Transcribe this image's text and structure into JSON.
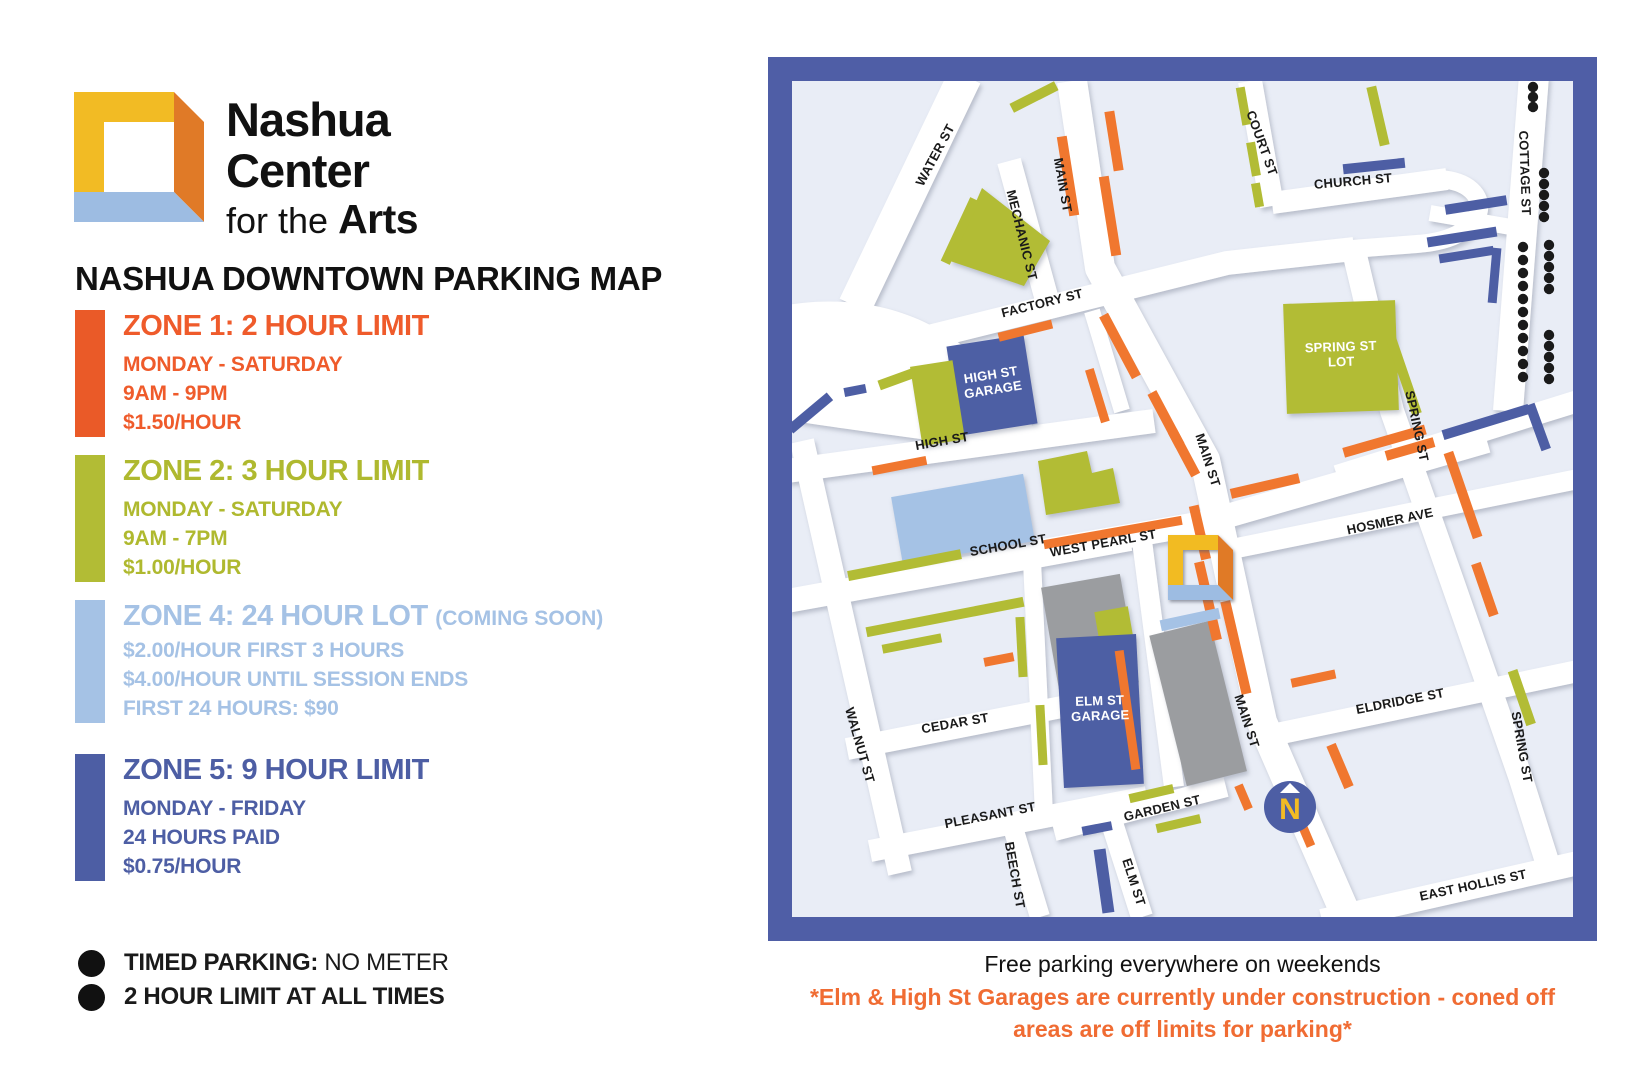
{
  "brand": {
    "name_line1": "Nashua",
    "name_line2": "Center",
    "name_line3_prefix": "for the ",
    "name_line3_bold": "Arts"
  },
  "page_title": "NASHUA DOWNTOWN PARKING MAP",
  "legend": {
    "zones": [
      {
        "name": "ZONE 1:",
        "limit": " 2 HOUR LIMIT",
        "color": "#EF5B2B",
        "details": [
          "MONDAY - SATURDAY",
          "9AM - 9PM",
          "$1.50/HOUR"
        ]
      },
      {
        "name": "ZONE 2:",
        "limit": " 3 HOUR LIMIT",
        "color": "#B2BC35",
        "details": [
          "MONDAY - SATURDAY",
          "9AM - 7PM",
          "$1.00/HOUR"
        ]
      },
      {
        "name": "ZONE 4:",
        "limit": " 24 HOUR LOT ",
        "note": "(COMING SOON)",
        "color": "#A5C2E5",
        "details": [
          "$2.00/HOUR FIRST 3 HOURS",
          "$4.00/HOUR UNTIL SESSION ENDS",
          "FIRST 24 HOURS: $90"
        ]
      },
      {
        "name": "ZONE 5:",
        "limit": " 9 HOUR LIMIT",
        "color": "#4D5EA4",
        "details": [
          "MONDAY - FRIDAY",
          "24 HOURS PAID",
          "$0.75/HOUR"
        ]
      }
    ],
    "timed": {
      "label_bold": "TIMED PARKING:",
      "label_rest": " NO METER",
      "line2": "2 HOUR LIMIT AT ALL TIMES"
    }
  },
  "map": {
    "streets": {
      "water": "WATER ST",
      "mechanic": "MECHANIC ST",
      "main": "MAIN ST",
      "court": "COURT ST",
      "church": "CHURCH ST",
      "cottage": "COTTAGE ST",
      "factory": "FACTORY ST",
      "spring": "SPRING ST",
      "high": "HIGH ST",
      "school": "SCHOOL ST",
      "west_pearl": "WEST PEARL ST",
      "hosmer": "HOSMER AVE",
      "walnut": "WALNUT ST",
      "cedar": "CEDAR ST",
      "pleasant": "PLEASANT ST",
      "beech": "BEECH ST",
      "garden": "GARDEN ST",
      "elm": "ELM ST",
      "eldridge": "ELDRIDGE ST",
      "east_hollis": "EAST HOLLIS ST"
    },
    "places": {
      "high_garage": "HIGH ST\nGARAGE",
      "elm_garage": "ELM ST\nGARAGE",
      "spring_lot": "SPRING ST\nLOT"
    },
    "compass": "N"
  },
  "footer": {
    "line1": "Free parking everywhere on weekends",
    "line2": "*Elm & High St Garages are currently under construction - coned off",
    "line3": "areas are off limits for parking*"
  },
  "colors": {
    "zone1_orange": "#EF5B2B",
    "zone2_olive": "#B2BC35",
    "zone4_lightblue": "#A5C2E5",
    "zone5_blue": "#4D5EA4",
    "timed_black": "#1A1A1A",
    "map_border_blue": "#4F5EA6",
    "map_background": "#E9EDF6",
    "building_gray": "#9B9DA0",
    "construction_orange": "#F06C33"
  }
}
